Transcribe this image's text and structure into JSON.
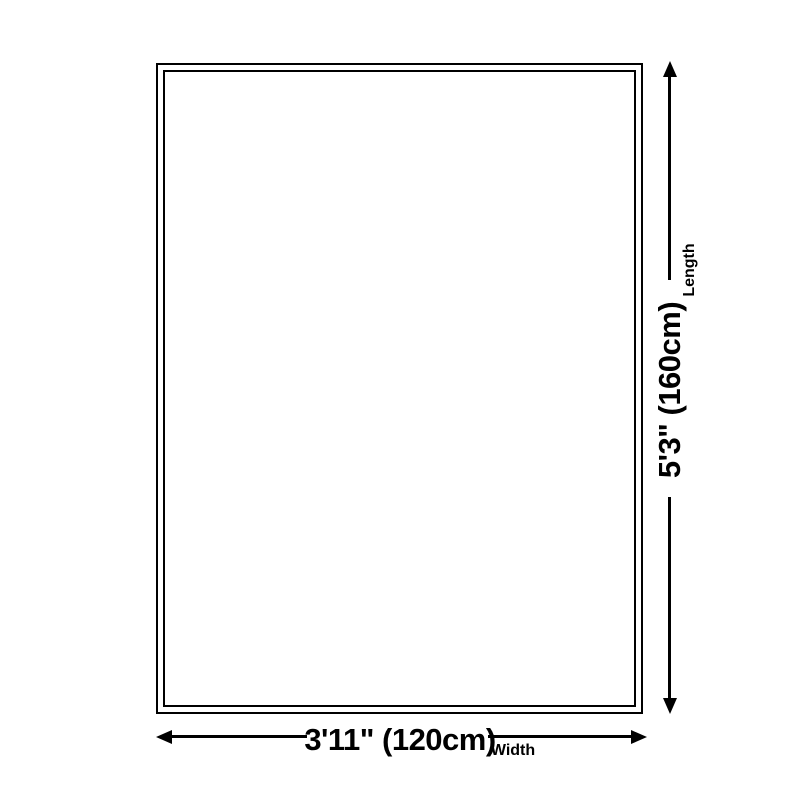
{
  "dimensions": {
    "length": {
      "value": "5'3\" (160cm)",
      "label": "Length"
    },
    "width": {
      "value": "3'11\" (120cm)",
      "label": "Width"
    }
  },
  "colors": {
    "line": "#000000",
    "background": "#ffffff"
  }
}
